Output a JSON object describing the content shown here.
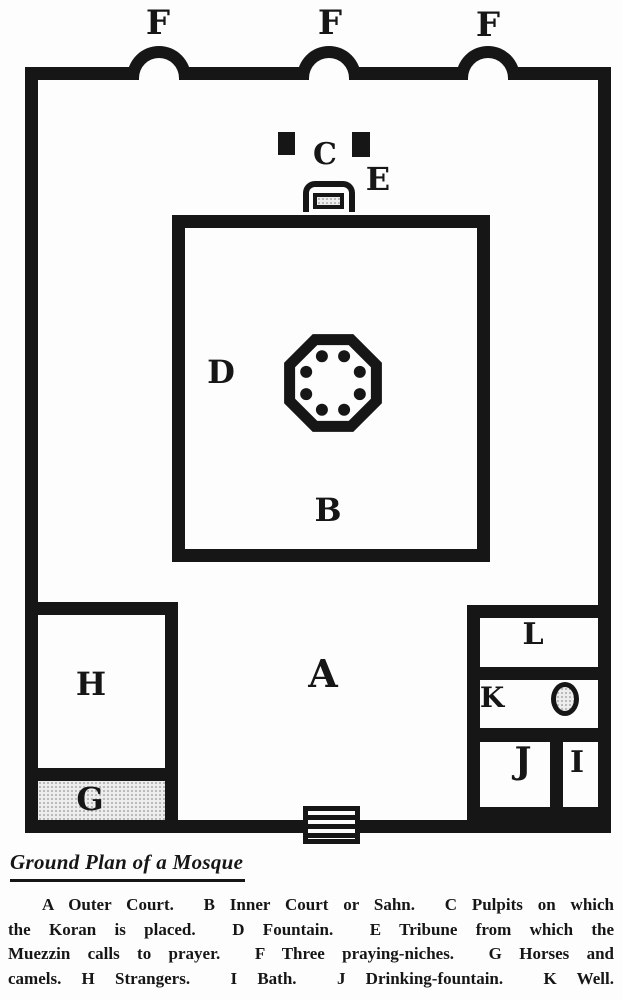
{
  "caption": "Ground Plan of a Mosque",
  "plan": {
    "labels": {
      "f": "F",
      "c": "C",
      "e": "E",
      "d": "D",
      "b": "B",
      "a": "A",
      "h": "H",
      "g": "G",
      "l": "L",
      "k": "K",
      "j": "J",
      "i": "I"
    }
  },
  "legend": {
    "lines": [
      "A Outer Court.  B Inner Court or Sahn.  C Pulpits on which",
      "the Koran is placed.  D Fountain.  E Tribune from which the",
      "Muezzin calls to prayer.  F Three praying-niches.  G Horses and",
      "camels. H Strangers.  I Bath.  J Drinking-fountain.  K Well."
    ],
    "entries": [
      {
        "key": "A",
        "meaning": "Outer Court"
      },
      {
        "key": "B",
        "meaning": "Inner Court or Sahn"
      },
      {
        "key": "C",
        "meaning": "Pulpits on which the Koran is placed"
      },
      {
        "key": "D",
        "meaning": "Fountain"
      },
      {
        "key": "E",
        "meaning": "Tribune from which the Muezzin calls to prayer"
      },
      {
        "key": "F",
        "meaning": "Three praying-niches"
      },
      {
        "key": "G",
        "meaning": "Horses and camels"
      },
      {
        "key": "H",
        "meaning": "Strangers"
      },
      {
        "key": "I",
        "meaning": "Bath"
      },
      {
        "key": "J",
        "meaning": "Drinking-fountain"
      },
      {
        "key": "K",
        "meaning": "Well"
      }
    ]
  },
  "colors": {
    "ink": "#161616",
    "paper": "#fdfdfd",
    "stipple_fill": "#ededed"
  }
}
